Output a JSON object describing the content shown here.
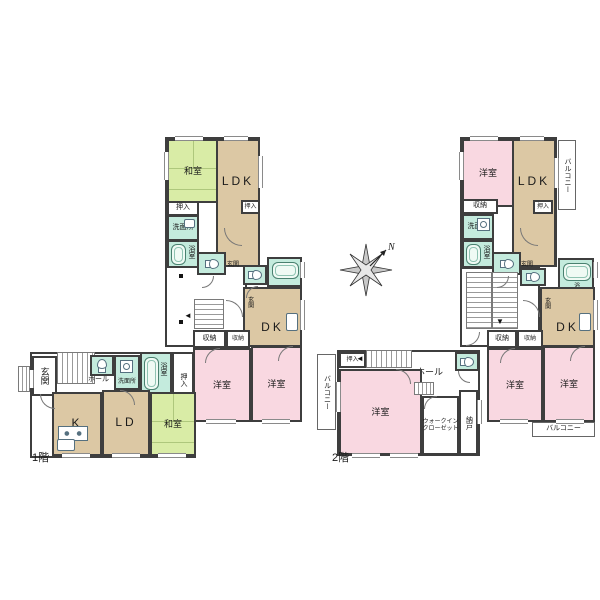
{
  "compass": {
    "north": "N"
  },
  "colors": {
    "tatami": "#d9eca6",
    "wood": "#dcc8a4",
    "western_pink": "#f9d8e1",
    "wet_teal": "#c4ebdd",
    "wall": "#3e3e3e"
  },
  "floor1": {
    "floor_label": "1階",
    "top": {
      "washitsu": "和室",
      "ldk": "LDK",
      "oshiire1": "押入",
      "oshiire2": "押入",
      "senmenjo": "洗面所",
      "yokushitsu": "浴室"
    },
    "mid": {
      "genkan1": "玄関",
      "genkan2": "玄関",
      "yokushitsu": "浴室",
      "dk": "DK",
      "shuno1": "収納",
      "shuno2": "収納",
      "yoshitsu1": "洋室",
      "yoshitsu2": "洋室"
    },
    "bottom": {
      "genkan": "玄関",
      "hall": "ホール",
      "senmenjo": "洗面所",
      "yokushitsu": "浴室",
      "oshiire": "押入",
      "k": "K",
      "ld": "LD",
      "washitsu": "和室"
    }
  },
  "floor2": {
    "floor_label": "2階",
    "top": {
      "yoshitsu": "洋室",
      "ldk": "LDK",
      "balcony": "バルコニー",
      "shuno": "収納",
      "oshiire": "押入",
      "senmenjo": "洗面所",
      "yokushitsu": "浴室"
    },
    "mid": {
      "genkan1": "玄関",
      "genkan2": "玄関",
      "yokushitsu": "浴室",
      "dk": "DK",
      "shuno1": "収納",
      "shuno2": "収納",
      "yoshitsu1": "洋室",
      "yoshitsu2": "洋室",
      "balcony": "バルコニー"
    },
    "bottom": {
      "balcony": "バルコニー",
      "oshiire": "押入",
      "hall": "ホール",
      "yoshitsu": "洋室",
      "wic1": "ウォークイン",
      "wic2": "クローゼット",
      "nando": "納戸"
    }
  }
}
